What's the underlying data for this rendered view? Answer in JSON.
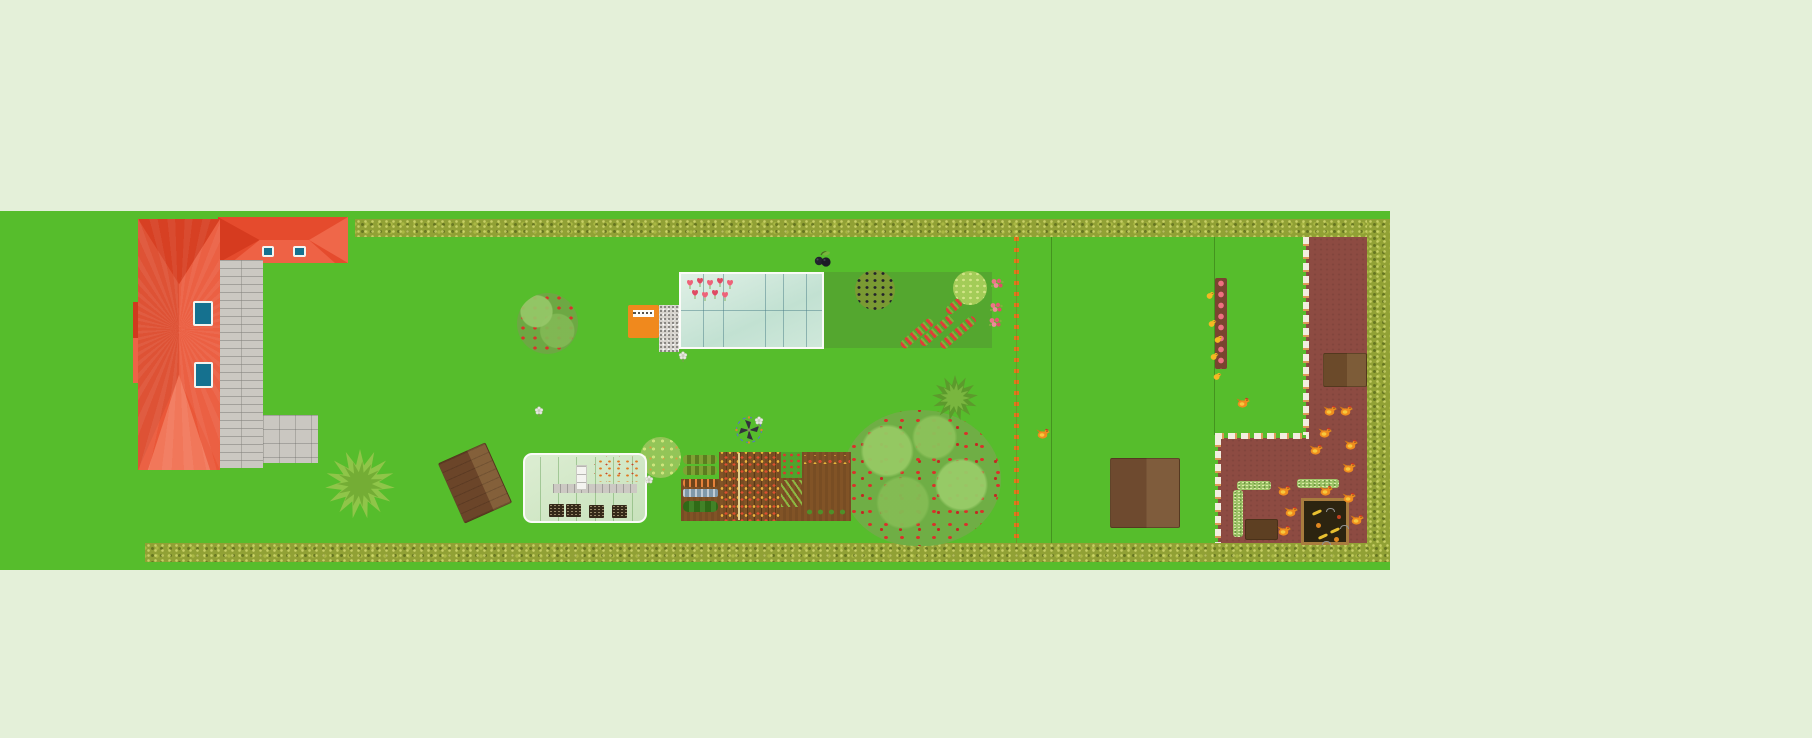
{
  "app": {
    "type": "garden-planner-canvas",
    "visible_text": [],
    "note": "top-down garden plan; no legible text rendered on canvas"
  },
  "palette": {
    "background": "#e4f0d9",
    "lawn": "#56bd2c",
    "dark_plot": "#54a72f",
    "hedge": "#91a135",
    "roof_red": "#ea5738",
    "roof_dark": "#d74023",
    "roof_light": "#f1775a",
    "skylight_blue": "#15718f",
    "path_gray": "#cbc8c2",
    "greenhouse_glass": "#cfe8da",
    "orange_box": "#f0891d",
    "soil_brown": "#815326",
    "chicken_run_brown": "#8d4b42",
    "shed_brown": "#6e4a2f",
    "hen_orange": "#ef8d1e",
    "chick_yellow": "#f6b723",
    "fence_dash_white": "#f2eee0",
    "fence_post_orange": "#e2771c",
    "compost_dark": "#2c2410"
  },
  "objects": {
    "lawn": {
      "bounds": [
        0,
        211,
        1390,
        359
      ]
    },
    "hedge_top": {
      "bounds": [
        355,
        219,
        1035,
        18
      ]
    },
    "hedge_right": {
      "bounds": [
        1367,
        219,
        23,
        343
      ]
    },
    "hedge_bottom": {
      "bounds": [
        145,
        543,
        1245,
        19
      ]
    },
    "house": {
      "main": [
        138,
        219,
        82,
        251
      ],
      "wing": [
        218,
        217,
        130,
        46
      ],
      "annex": [
        133,
        302,
        24,
        81
      ],
      "skylights": 4
    },
    "walkway": {
      "bounds": [
        220,
        260,
        43,
        208
      ]
    },
    "patio": {
      "bounds": [
        263,
        415,
        55,
        48
      ]
    },
    "greenhouse_large": {
      "bounds": [
        679,
        272,
        145,
        77
      ],
      "tulip_count": 9
    },
    "greenhouse_small": {
      "bounds": [
        523,
        453,
        124,
        70
      ],
      "seed_trays": 4,
      "has_path": true,
      "has_shelf": true
    },
    "storage_box_orange": {
      "bounds": [
        628,
        305,
        31,
        33
      ],
      "has_small_white_label": true
    },
    "gravel_pad": {
      "bounds": [
        659,
        305,
        20,
        47
      ]
    },
    "dark_green_plot": {
      "bounds": [
        824,
        272,
        168,
        76
      ]
    },
    "apple_tree": {
      "bounds": [
        517,
        293,
        61,
        61
      ]
    },
    "big_apple_tree": {
      "bounds": [
        843,
        410,
        158,
        136
      ]
    },
    "green_apple_tree": {
      "bounds": [
        640,
        437,
        41,
        41
      ]
    },
    "blackcurrant_tree": {
      "bounds": [
        855,
        270,
        40,
        40
      ]
    },
    "light_bush": {
      "bounds": [
        953,
        271,
        34,
        34
      ]
    },
    "grape_plant": {
      "bounds": [
        813,
        249,
        20,
        20
      ]
    },
    "windmill": {
      "bounds": [
        734,
        415,
        30,
        30
      ]
    },
    "shed_tilted": {
      "center": [
        475,
        483
      ],
      "size": [
        52,
        66
      ],
      "angle_deg": -24
    },
    "storage_shed": {
      "bounds": [
        1110,
        458,
        70,
        70
      ]
    },
    "vegetable_garden": {
      "bounds": [
        681,
        452,
        170,
        69
      ]
    },
    "chicken_run": {
      "rect_right": [
        1306,
        237,
        61,
        306
      ],
      "rect_bottom": [
        1218,
        438,
        91,
        105
      ]
    },
    "chicken_coop": {
      "bounds": [
        1323,
        353,
        44,
        34
      ]
    },
    "compost_bin": {
      "bounds": [
        1301,
        498,
        48,
        47
      ]
    },
    "wood_box": {
      "bounds": [
        1245,
        519,
        33,
        21
      ]
    },
    "flower_bed_vertical": {
      "bounds": [
        1215,
        278,
        12,
        91
      ]
    },
    "fence_orange_dotted": {
      "x": 1014,
      "y1": 237,
      "y2": 543
    },
    "boundary_lines": [
      {
        "x": 1051,
        "y1": 237,
        "y2": 543
      },
      {
        "x": 1214,
        "y1": 237,
        "y2": 435
      }
    ],
    "fence_dashed": {
      "v1": [
        1303,
        237,
        198
      ],
      "h": [
        1215,
        433,
        94
      ],
      "v2": [
        1215,
        438,
        105
      ]
    }
  },
  "decor": {
    "hens": [
      [
        1036,
        425
      ],
      [
        1236,
        394
      ],
      [
        1323,
        402
      ],
      [
        1339,
        402
      ],
      [
        1318,
        424
      ],
      [
        1309,
        441
      ],
      [
        1344,
        436
      ],
      [
        1342,
        459
      ],
      [
        1277,
        482
      ],
      [
        1319,
        482
      ],
      [
        1342,
        489
      ],
      [
        1284,
        503
      ],
      [
        1350,
        511
      ],
      [
        1277,
        522
      ]
    ],
    "chicks": [
      [
        1206,
        285
      ],
      [
        1208,
        313
      ],
      [
        1214,
        329
      ],
      [
        1210,
        346
      ],
      [
        1213,
        366
      ]
    ],
    "gray_flowers": [
      [
        534,
        403
      ],
      [
        678,
        348
      ],
      [
        644,
        472
      ],
      [
        754,
        413
      ]
    ],
    "tulips": [
      [
        686,
        275
      ],
      [
        696,
        273
      ],
      [
        706,
        275
      ],
      [
        716,
        273
      ],
      [
        726,
        275
      ],
      [
        691,
        285
      ],
      [
        701,
        287
      ],
      [
        711,
        285
      ],
      [
        721,
        287
      ]
    ],
    "roses": [
      [
        990,
        276
      ],
      [
        989,
        300
      ],
      [
        988,
        315
      ]
    ],
    "flower_rows": [
      {
        "cx": 917,
        "cy": 333,
        "len": 40,
        "angle": -41
      },
      {
        "cx": 937,
        "cy": 330,
        "len": 42,
        "angle": -41
      },
      {
        "cx": 958,
        "cy": 332,
        "len": 44,
        "angle": -41
      },
      {
        "cx": 954,
        "cy": 306,
        "len": 18,
        "angle": -41
      }
    ],
    "star_bushes": [
      {
        "cx": 360,
        "cy": 484,
        "R": 35,
        "r": 19,
        "n": 15,
        "fill": "#8fc549",
        "fill2": "#74ad35"
      },
      {
        "cx": 955,
        "cy": 398,
        "R": 23,
        "r": 13,
        "n": 13,
        "fill": "#5c9a2c",
        "fill2": "#79b63f"
      }
    ],
    "compost_scraps": [
      [
        8,
        10,
        "banana"
      ],
      [
        26,
        28,
        "banana"
      ],
      [
        14,
        34,
        "banana"
      ],
      [
        33,
        14,
        "red"
      ],
      [
        12,
        22,
        "orange"
      ],
      [
        30,
        36,
        "orange"
      ],
      [
        22,
        7,
        "worm"
      ],
      [
        36,
        24,
        "worm"
      ],
      [
        18,
        40,
        "worm"
      ]
    ]
  }
}
